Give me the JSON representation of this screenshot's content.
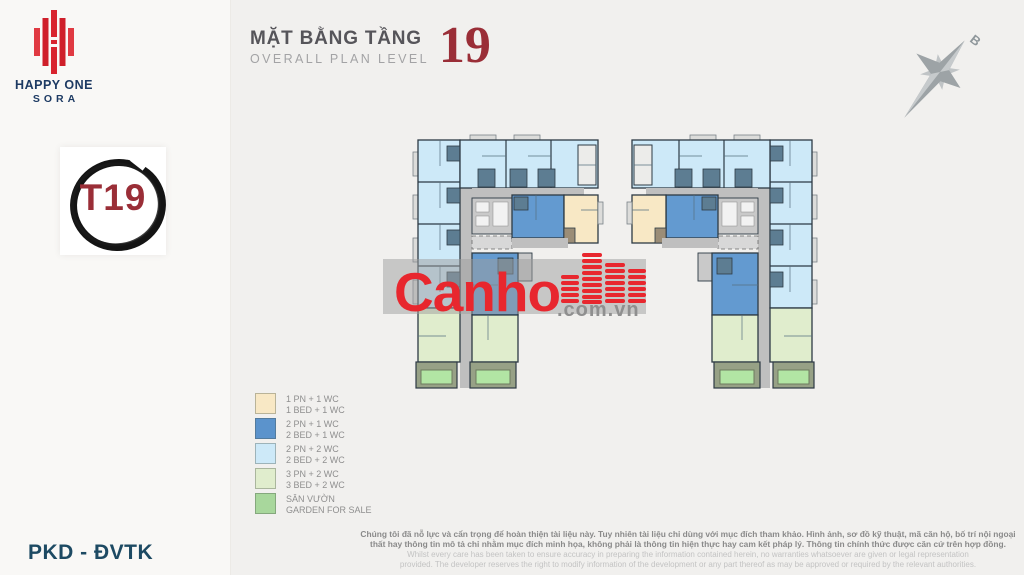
{
  "theme": {
    "page-bg": "#f1f0ee",
    "sidebar-bg": "#f9f8f6",
    "title-dark": "#56555a",
    "title-light": "#a3a3a5",
    "accent-red": "#9a2e37",
    "logo-red": "#d8232e",
    "logo-navy": "#1d3a63",
    "footer-navy": "#1d4a63",
    "unit-1bed": "#f8e8c5",
    "unit-2bed1wc": "#639ad0",
    "unit-2bed2wc": "#cde9f8",
    "unit-3bed": "#e0edcd",
    "garden": "#a8d79c",
    "garden-bright": "#b2e5a4",
    "corridor": "#bfbfbf",
    "core-dark": "#5d7d92",
    "wall": "#2d3a44",
    "watermark-red": "#e8272e",
    "compass-gray": "#9da3a6"
  },
  "icons": {
    "brand": "happy-one-bars-icon",
    "badge_ring": "brush-circle-icon",
    "compass": "compass-star-icon",
    "watermark_buildings": "buildings-bars-icon"
  },
  "sidebar": {
    "brand": {
      "name": "HAPPY ONE",
      "sub": "SORA"
    },
    "badge": {
      "label": "T19"
    },
    "footer": "PKD - ĐVTK"
  },
  "header": {
    "title_vi": "MẶT BẰNG TẦNG",
    "title_en": "OVERALL PLAN LEVEL",
    "level_number": "19"
  },
  "compass": {
    "north_label": "B"
  },
  "watermark": {
    "brand": "Canho",
    "domain": ".com.vn"
  },
  "legend": {
    "items": [
      {
        "key": "unit-1bed",
        "line1": "1 PN + 1 WC",
        "line2": "1 BED + 1 WC"
      },
      {
        "key": "unit-2bed1wc",
        "line1": "2 PN + 1 WC",
        "line2": "2 BED + 1 WC"
      },
      {
        "key": "unit-2bed2wc",
        "line1": "2 PN + 2 WC",
        "line2": "2 BED + 2 WC"
      },
      {
        "key": "unit-3bed",
        "line1": "3 PN + 2 WC",
        "line2": "3 BED + 2 WC"
      },
      {
        "key": "garden",
        "line1": "SÂN VƯỜN",
        "line2": "GARDEN FOR SALE"
      }
    ]
  },
  "disclaimer": {
    "vi_line1": "Chúng tôi đã nỗ lực và cẩn trọng để hoàn thiện tài liệu này. Tuy nhiên tài liệu chỉ dùng với mục đích tham khảo. Hình ảnh, sơ đồ kỹ thuật, mã căn hộ, bố trí nội ngoại",
    "vi_line2": "thất hay thông tin mô tả chỉ nhằm mục đích minh họa, không phải là thông tin hiện thực hay cam kết pháp lý. Thông tin chính thức được căn cứ trên hợp đồng.",
    "en_line1": "Whilst every care has been taken to ensure accuracy in preparing the information contained herein, no warranties whatsoever are given or legal representation",
    "en_line2": "provided. The developer reserves the right to modify information of the development or any part thereof as may be approved or required by the relevant authorities."
  }
}
